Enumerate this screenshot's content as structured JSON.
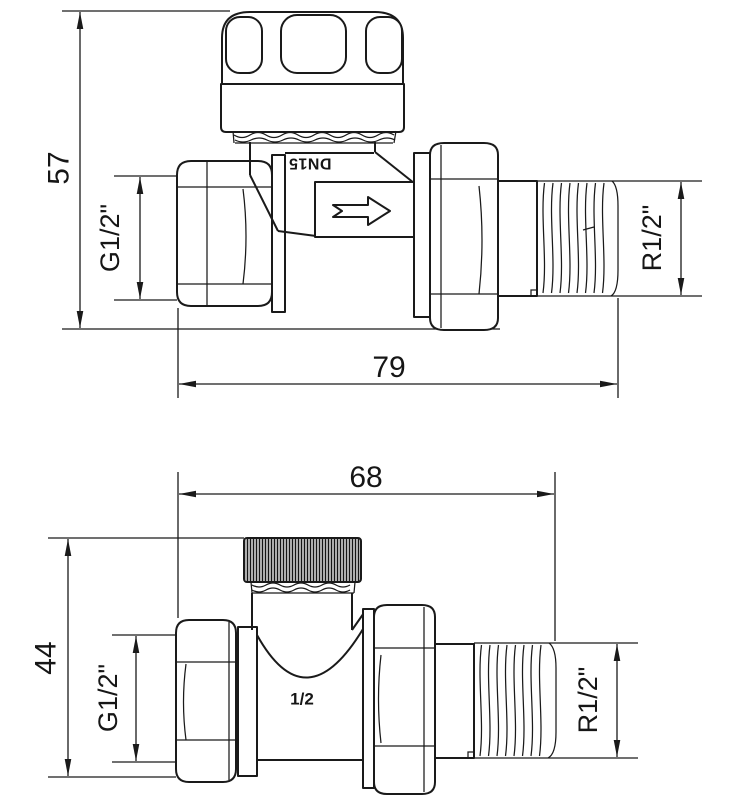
{
  "colors": {
    "line": "#1a1a1a",
    "background": "#ffffff"
  },
  "top_view": {
    "height_mm": "57",
    "length_mm": "79",
    "inlet_thread": "G1/2\"",
    "outlet_thread": "R1/2\"",
    "body_marking": "DN15"
  },
  "bottom_view": {
    "height_mm": "44",
    "length_mm": "68",
    "inlet_thread": "G1/2\"",
    "outlet_thread": "R1/2\"",
    "body_marking": "1/2"
  }
}
